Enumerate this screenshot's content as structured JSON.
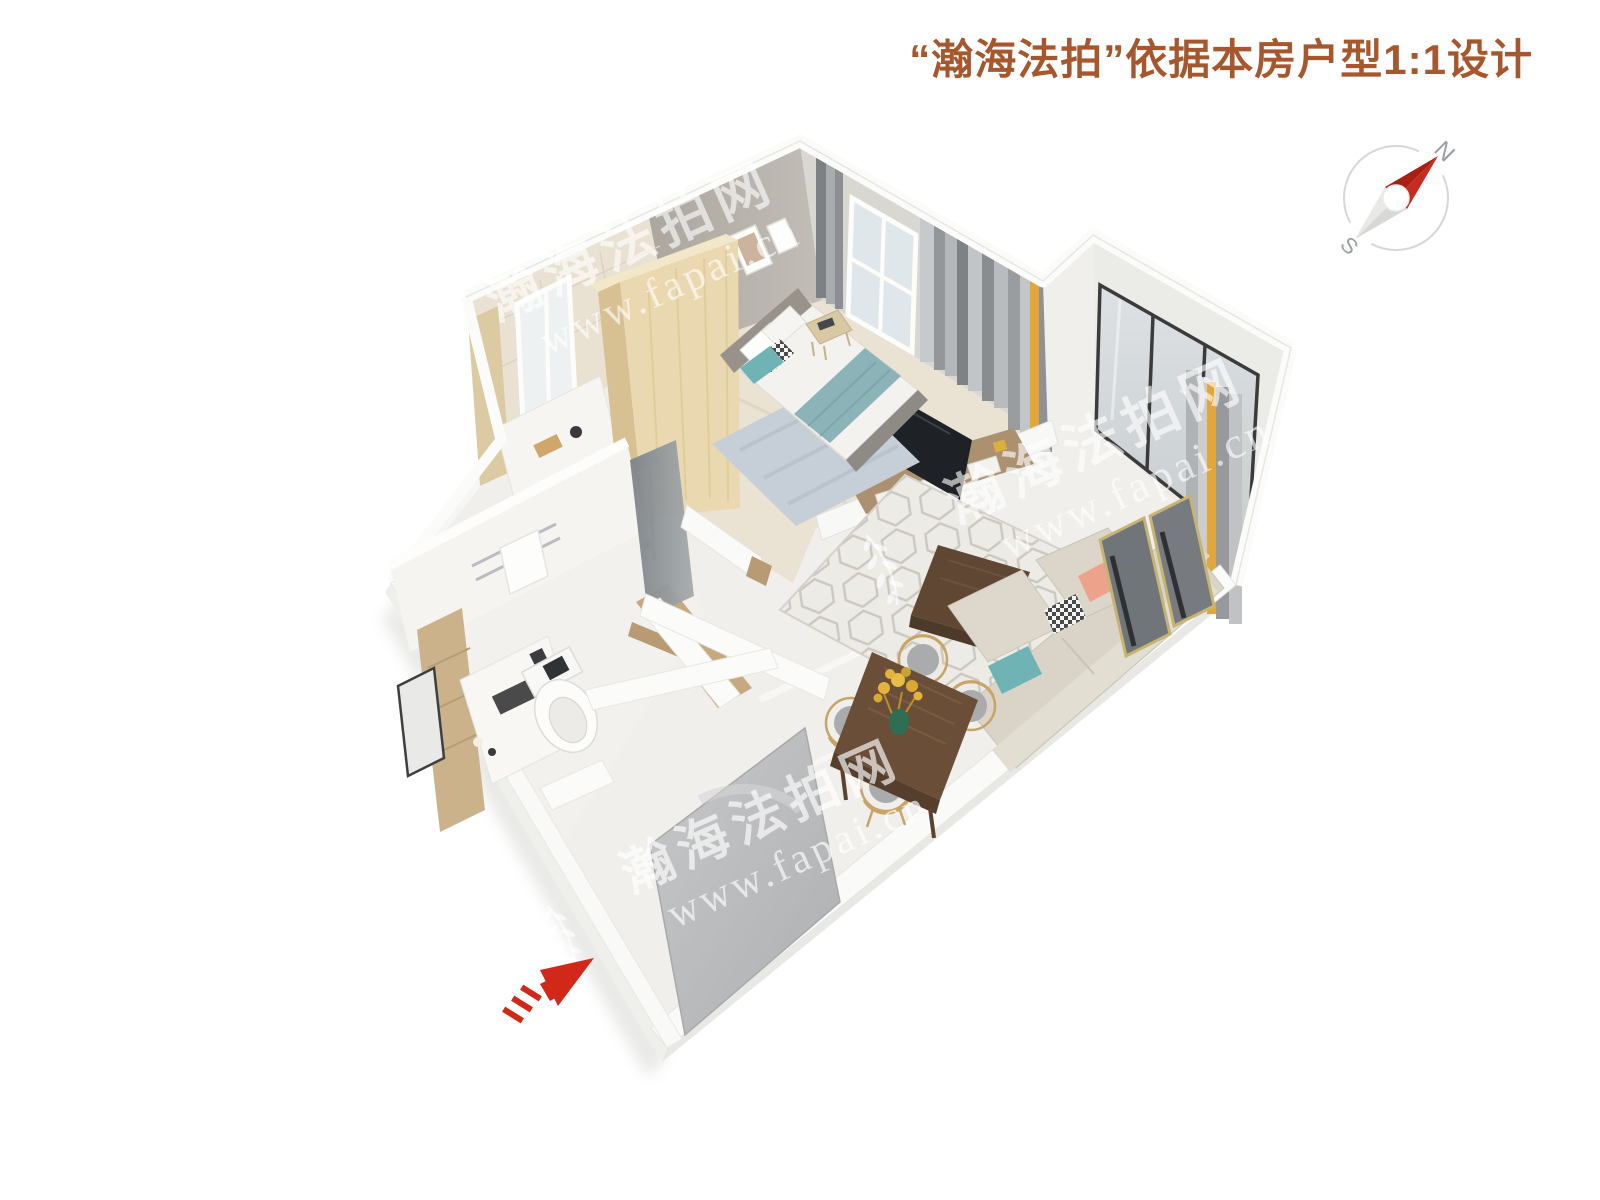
{
  "header": {
    "title": "“瀚海法拍”依据本房户型1:1设计"
  },
  "compass": {
    "north": "N",
    "south": "S"
  },
  "watermark": {
    "name": "瀚海法拍网",
    "url": "www.fapai.cn"
  },
  "palette": {
    "title_color": "#a6572e",
    "arrow_red": "#d2281a",
    "compass_needle_red": "#c62b1d",
    "compass_needle_red_dark": "#a81f15",
    "curtain_accent_yellow": "#e2a73b",
    "bedroom_wall_gray": "#b6b1aa",
    "wardrobe_wood": "#ead9b0",
    "table_wood_dark": "#6a4e37",
    "bed_throw_teal": "#8cb4b8",
    "pillow_teal": "#6fb3b5",
    "pillow_pink": "#eda28c",
    "floor_white": "#f0efec",
    "entrance_door_gray": "#b9babc"
  }
}
